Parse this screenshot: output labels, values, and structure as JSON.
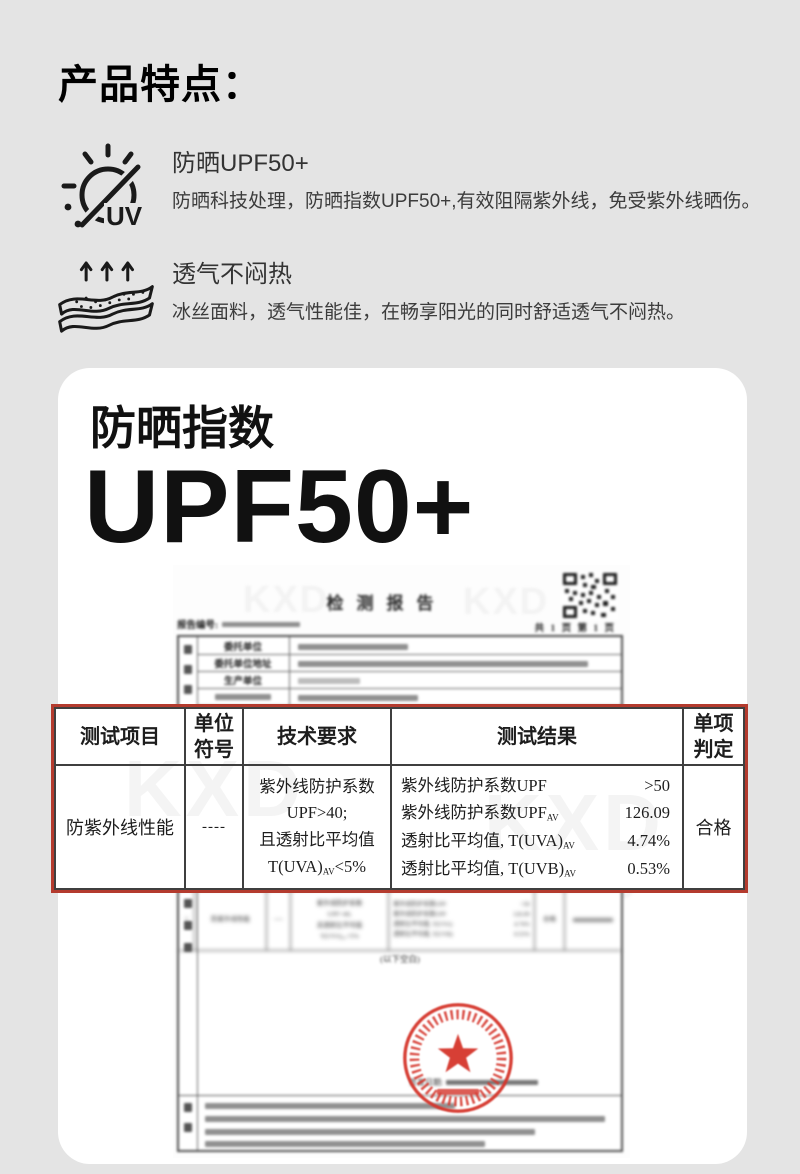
{
  "header": {
    "title": "产品特点："
  },
  "features": [
    {
      "icon": "uv-protection-icon",
      "title": "防晒UPF50+",
      "desc": "防晒科技处理，防晒指数UPF50+,有效阻隔紫外线，免受紫外线晒伤。"
    },
    {
      "icon": "breathable-fabric-icon",
      "title": "透气不闷热",
      "desc": "冰丝面料，透气性能佳，在畅享阳光的同时舒适透气不闷热。"
    }
  ],
  "card": {
    "subtitle": "防晒指数",
    "headline": "UPF50+"
  },
  "report": {
    "title": "检测报告",
    "report_no_label": "报告编号:",
    "pages": "共 1 页   第 1 页",
    "watermark": "KXD",
    "header_rows": [
      "委托单位",
      "委托单位地址",
      "生产单位"
    ],
    "row_no": "1",
    "below_blank": "(以下空白)",
    "issue_date_label": "签发日期:",
    "table": {
      "headers": [
        "测试项目",
        "单位符号",
        "技术要求",
        "测试结果",
        "单项判定"
      ],
      "row": {
        "item": "防紫外线性能",
        "unit": "----",
        "requirement_lines": [
          "紫外线防护系数",
          "UPF>40;",
          "且透射比平均值"
        ],
        "requirement_last": {
          "prefix": "T(UVA)",
          "sub": "AV",
          "suffix": "<5%"
        },
        "results": [
          {
            "label": "紫外线防护系数UPF",
            "sub": "",
            "value": ">50"
          },
          {
            "label": "紫外线防护系数UPF",
            "sub": "AV",
            "value": "126.09"
          },
          {
            "label": "透射比平均值, T(UVA)",
            "sub": "AV",
            "value": "4.74%"
          },
          {
            "label": "透射比平均值, T(UVB)",
            "sub": "AV",
            "value": "0.53%"
          }
        ],
        "verdict": "合格"
      }
    }
  },
  "colors": {
    "page_bg": "#e4e4e4",
    "card_bg": "#ffffff",
    "ink": "#141414",
    "highlight_border_red": "#b43b2e",
    "stamp_red": "#d5352b",
    "table_border": "#3f3f3f"
  }
}
